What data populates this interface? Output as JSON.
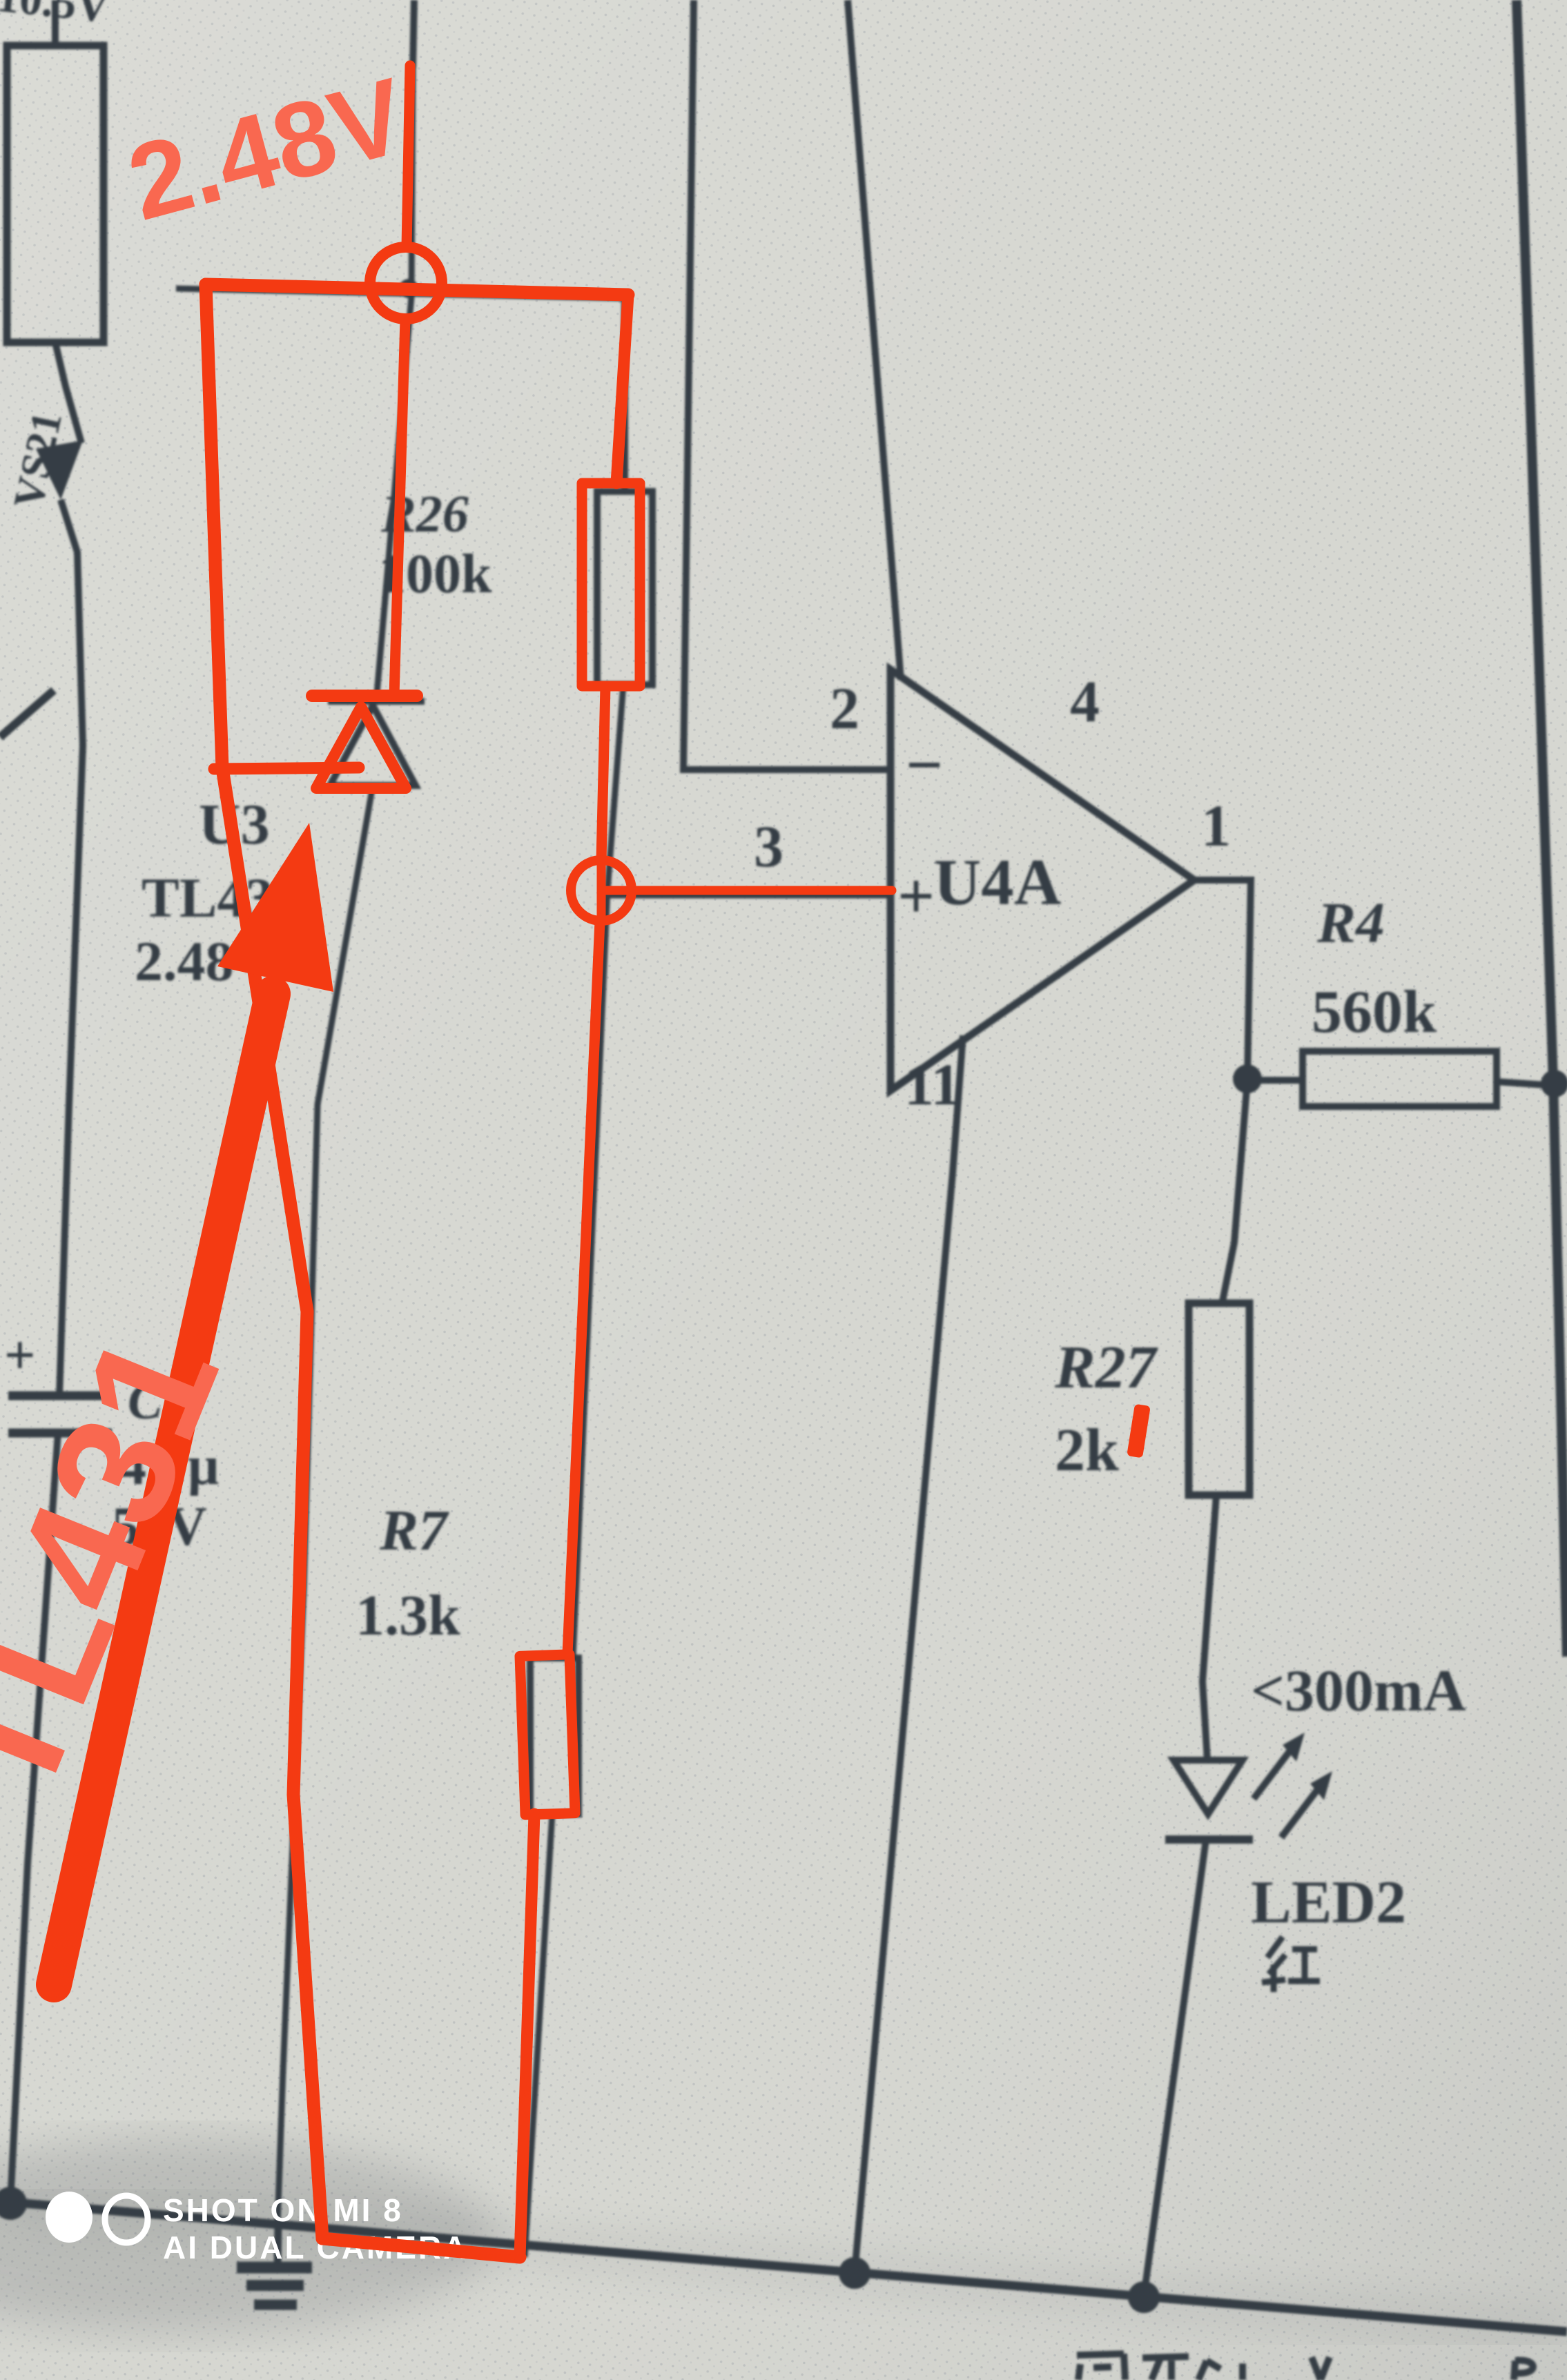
{
  "colors": {
    "paper": "#d6d7d1",
    "ink": "#363d45",
    "red_trace": "#f43a12",
    "red_text": "#f96850",
    "watermark": "#ffffff"
  },
  "title_fragments": {
    "top_left": "10.5V",
    "bottom_center": "调在4.4V",
    "bottom_right": "R"
  },
  "components": {
    "vs21": {
      "ref": "VS21"
    },
    "c9": {
      "ref": "C9",
      "value": "4.7μ",
      "rating": "50V",
      "polarity": "+"
    },
    "u3": {
      "ref": "U3",
      "part": "TL431",
      "voltage": "2.48V"
    },
    "r26": {
      "ref": "R26",
      "value": "100k"
    },
    "r7": {
      "ref": "R7",
      "value": "1.3k"
    },
    "r4": {
      "ref": "R4",
      "value": "560k"
    },
    "r27": {
      "ref": "R27",
      "value": "2k"
    },
    "led2": {
      "ref": "LED2",
      "color": "红",
      "current_limit": "<300mA"
    },
    "u4a": {
      "ref": "U4A",
      "pins": {
        "inverting": "2",
        "non_inverting": "3",
        "v_plus": "4",
        "v_minus": "11",
        "output": "1"
      },
      "signs": {
        "minus": "−",
        "plus": "+"
      }
    }
  },
  "annotations": {
    "node_voltage": "2.48V",
    "part_label": "TL431"
  },
  "watermark": {
    "line1": "SHOT ON MI 8",
    "line2": "AI DUAL CAMERA"
  }
}
